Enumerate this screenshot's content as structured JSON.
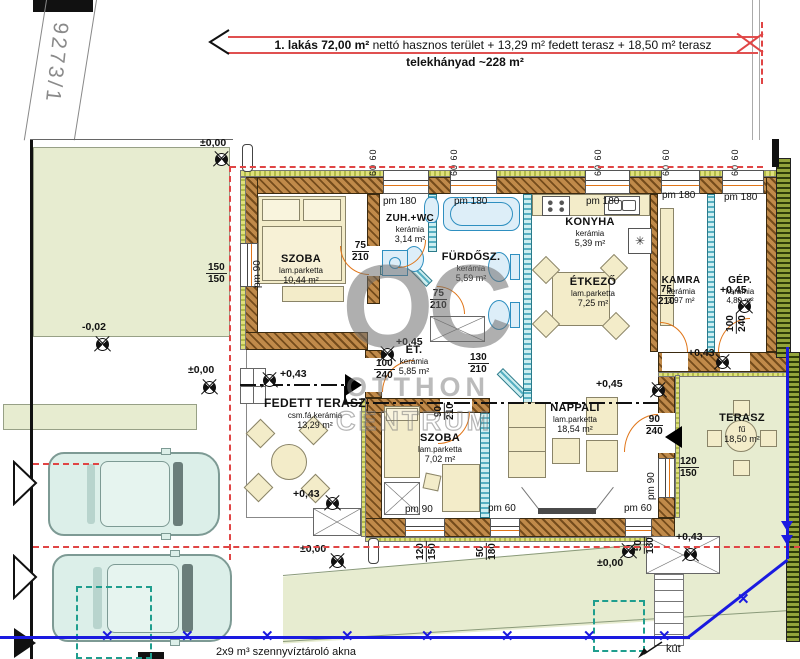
{
  "header": {
    "bold": "1. lakás  72,00 m²",
    "regular": "nettó hasznos terület + 13,29 m² fedett terasz + 18,50 m² terasz",
    "line2": "telekhányad ~228 m²"
  },
  "site": {
    "parcel": "9273/1",
    "sewer_note": "2x9 m³ szennyvíztároló akna",
    "well": "kút"
  },
  "watermark": {
    "logo": "OC",
    "line1": "OTTHON",
    "line2": "CENTRUM"
  },
  "rooms": [
    {
      "name": "SZOBA",
      "material": "lam.parketta",
      "area": "10,44 m²"
    },
    {
      "name": "ZUH.+WC",
      "material": "kerámia",
      "area": "3,14 m²"
    },
    {
      "name": "FÜRDŐSZ.",
      "material": "kerámia",
      "area": "5,59 m²"
    },
    {
      "name": "KONYHA",
      "material": "kerámia",
      "area": "5,39 m²"
    },
    {
      "name": "ÉTKEZŐ",
      "material": "lam.parketta",
      "area": "7,25 m²"
    },
    {
      "name": "KAMRA",
      "material": "kerámia",
      "area": "3,97 m²"
    },
    {
      "name": "GÉP.",
      "material": "kerámia",
      "area": "4,80 m²"
    },
    {
      "name": "ET.",
      "material": "kerámia",
      "area": "5,85 m²"
    },
    {
      "name": "FEDETT TERASZ",
      "material": "csm.fá.kerámia",
      "area": "13,29 m²"
    },
    {
      "name": "SZOBA",
      "material": "lam.parketta",
      "area": "7,02 m²"
    },
    {
      "name": "NAPPALI",
      "material": "lam.parketta",
      "area": "18,54 m²"
    },
    {
      "name": "TERASZ",
      "material": "fű",
      "area": "18,50 m²"
    }
  ],
  "levels": {
    "zero": "±0,00",
    "minus2": "-0,02",
    "p43": "+0,43",
    "p45": "+0,45"
  },
  "dims": {
    "pm180": "pm 180",
    "pm90": "pm 90",
    "pm60": "pm 60",
    "d60pair": "60  60",
    "f75_210": {
      "t": "75",
      "b": "210"
    },
    "f150_150": {
      "t": "150",
      "b": "150"
    },
    "f100_240": {
      "t": "100",
      "b": "240"
    },
    "f130_210": {
      "t": "130",
      "b": "210"
    },
    "f90_210": {
      "t": "90",
      "b": "210"
    },
    "f90_240": {
      "t": "90",
      "b": "240"
    },
    "f120_150": {
      "t": "120",
      "b": "150"
    },
    "f50_180": {
      "t": "50",
      "b": "180"
    }
  }
}
